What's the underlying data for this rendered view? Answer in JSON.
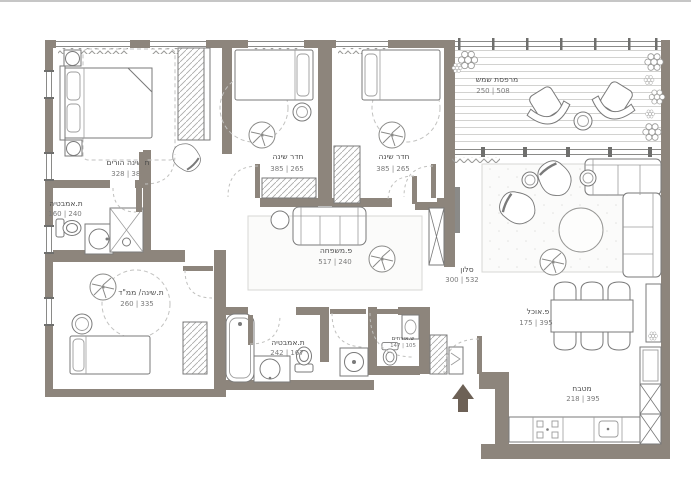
{
  "rooms": [
    {
      "id": "master-bedroom",
      "label": "ת.שינה הורים",
      "dims": "328 | 382"
    },
    {
      "id": "master-bathroom",
      "label": "ת.אמבטיה",
      "dims": "160 | 240"
    },
    {
      "id": "bedroom-1",
      "label": "חדר שינה",
      "dims": "385 | 265"
    },
    {
      "id": "bedroom-2",
      "label": "חדר שינה",
      "dims": "385 | 265"
    },
    {
      "id": "sun-balcony",
      "label": "מרפסת שמש",
      "dims": "250 | 508"
    },
    {
      "id": "family-corner",
      "label": "פ.משפחה",
      "dims": "517 | 240"
    },
    {
      "id": "living-room",
      "label": "סלון",
      "dims": "300 | 532"
    },
    {
      "id": "safe-room-bedroom",
      "label": "ת.שינה/ ממ\"ד",
      "dims": "260 | 335"
    },
    {
      "id": "bathroom",
      "label": "ת.אמבטיה",
      "dims": "242 | 167"
    },
    {
      "id": "guest-wc",
      "label": "ש.אורחים",
      "dims": "147 | 105"
    },
    {
      "id": "dining-corner",
      "label": "פ.אוכל",
      "dims": "175 | 395"
    },
    {
      "id": "kitchen",
      "label": "מטבח",
      "dims": "218 | 395"
    }
  ],
  "colors": {
    "wall": "#8d857c",
    "entry_arrow": "#6d6156"
  }
}
